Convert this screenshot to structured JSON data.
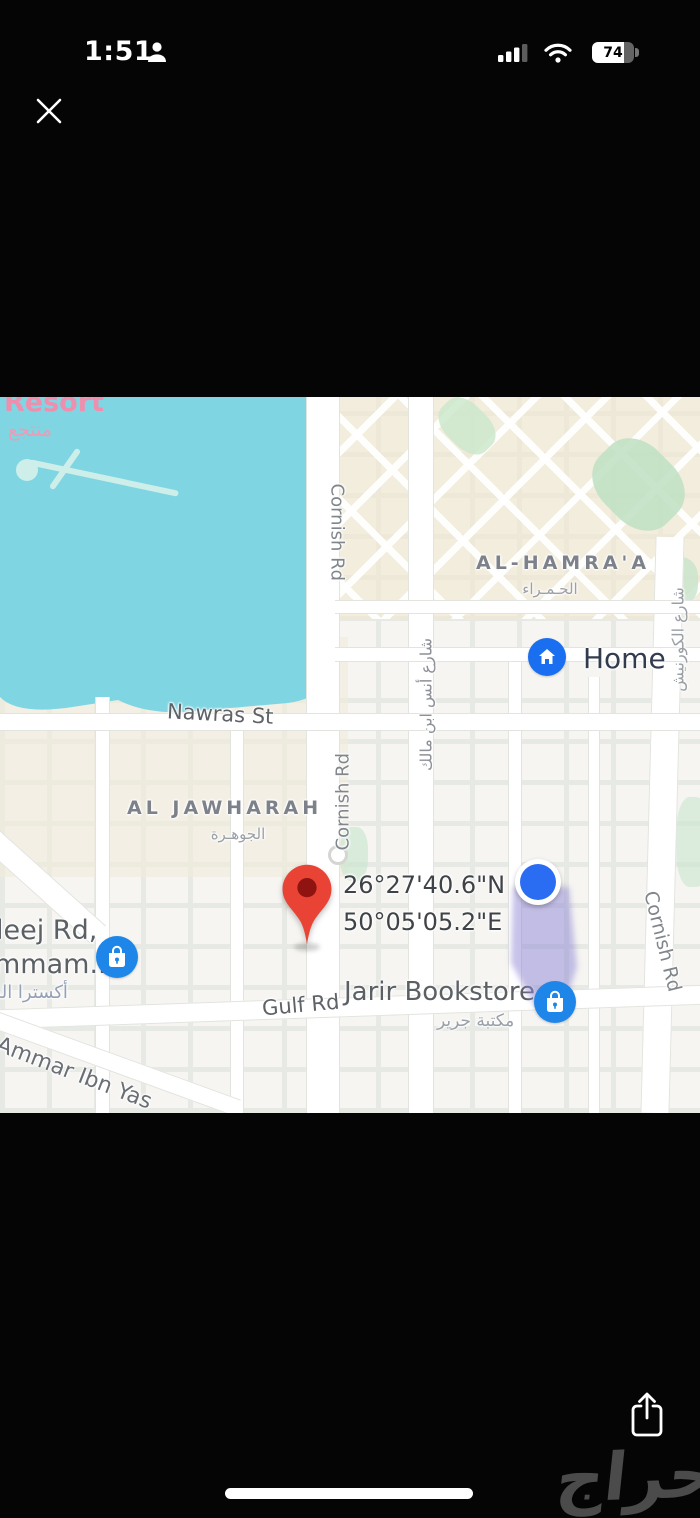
{
  "status_bar": {
    "time": "1:51",
    "battery_percent": "74"
  },
  "map": {
    "labels": {
      "resort": "Resort",
      "resort_ar": "منتجع",
      "cornish_top": "Cornish Rd",
      "cornish_mid": "Cornish Rd",
      "cornish_right": "Cornish Rd",
      "cornish_street_ar": "شارع الكورنيش",
      "anas_street_ar": "شارع أنس ابن مالك",
      "nawras": "Nawras St",
      "al_hamraa": "AL-HAMRA'A",
      "al_hamraa_ar": "الحـمـراء",
      "al_jawharah": "AL JAWHARAH",
      "al_jawharah_ar": "الجوهـرة",
      "khaleej_line1": "leej Rd,",
      "khaleej_line2": "mmam...",
      "khaleej_ar": "أكسترا الدمام",
      "gulf": "Gulf Rd",
      "ammar": "Ammar Ibn Yas"
    },
    "pois": {
      "home_label": "Home",
      "jarir_label": "Jarir Bookstore",
      "jarir_label_ar": "مكتبة جرير"
    },
    "pin": {
      "lat": "26°27'40.6\"N",
      "lng": "50°05'05.2\"E"
    },
    "colors": {
      "water": "#7fd6e2",
      "pin_red": "#e94335",
      "poi_blue": "#1d86e8",
      "location_blue": "#2a6cf2",
      "beam_purple": "#8d86d6",
      "resort_pink": "#ef8fae"
    }
  },
  "watermark": "حراج"
}
